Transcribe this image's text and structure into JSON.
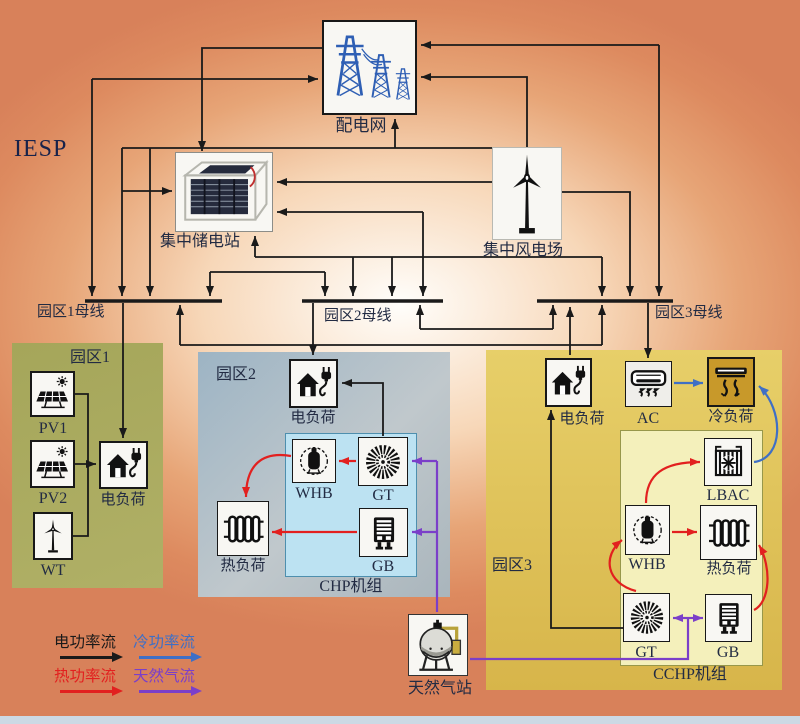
{
  "title": "IESP",
  "top": {
    "grid": "配电网",
    "storage": "集中储电站",
    "wind": "集中风电场",
    "gas": "天然气站"
  },
  "buses": {
    "b1": "园区1母线",
    "b2": "园区2母线",
    "b3": "园区3母线"
  },
  "park1": {
    "title": "园区1",
    "pv1": "PV1",
    "pv2": "PV2",
    "wt": "WT",
    "eload": "电负荷"
  },
  "park2": {
    "title": "园区2",
    "eload": "电负荷",
    "whb": "WHB",
    "gt": "GT",
    "gb": "GB",
    "heat": "热负荷",
    "unit": "CHP机组"
  },
  "park3": {
    "title": "园区3",
    "eload": "电负荷",
    "ac": "AC",
    "cool": "冷负荷",
    "lbac": "LBAC",
    "whb": "WHB",
    "heat": "热负荷",
    "gt": "GT",
    "gb": "GB",
    "unit": "CCHP机组"
  },
  "legend": {
    "electric": {
      "label": "电功率流",
      "color": "#1a1a1a"
    },
    "cooling": {
      "label": "冷功率流",
      "color": "#3f6fc5"
    },
    "heat": {
      "label": "热功率流",
      "color": "#e2201f"
    },
    "gas": {
      "label": "天然气流",
      "color": "#7b3fc9"
    }
  },
  "colors": {
    "background_orange": "#dd8a5f",
    "park1_fill": "#a9aa5e",
    "park2_fill": "#a4b8c5",
    "chp_fill": "#bce2f2",
    "park3_fill": "#e2c65c",
    "cchp_fill": "#f4f0bb",
    "cool_load_fill": "#c8992a",
    "electric_flow": "#1a1a1a",
    "heat_flow": "#e2201f",
    "cooling_flow": "#3f6fc5",
    "gas_flow": "#7b3fc9",
    "tower_blue": "#2f5fb4"
  }
}
